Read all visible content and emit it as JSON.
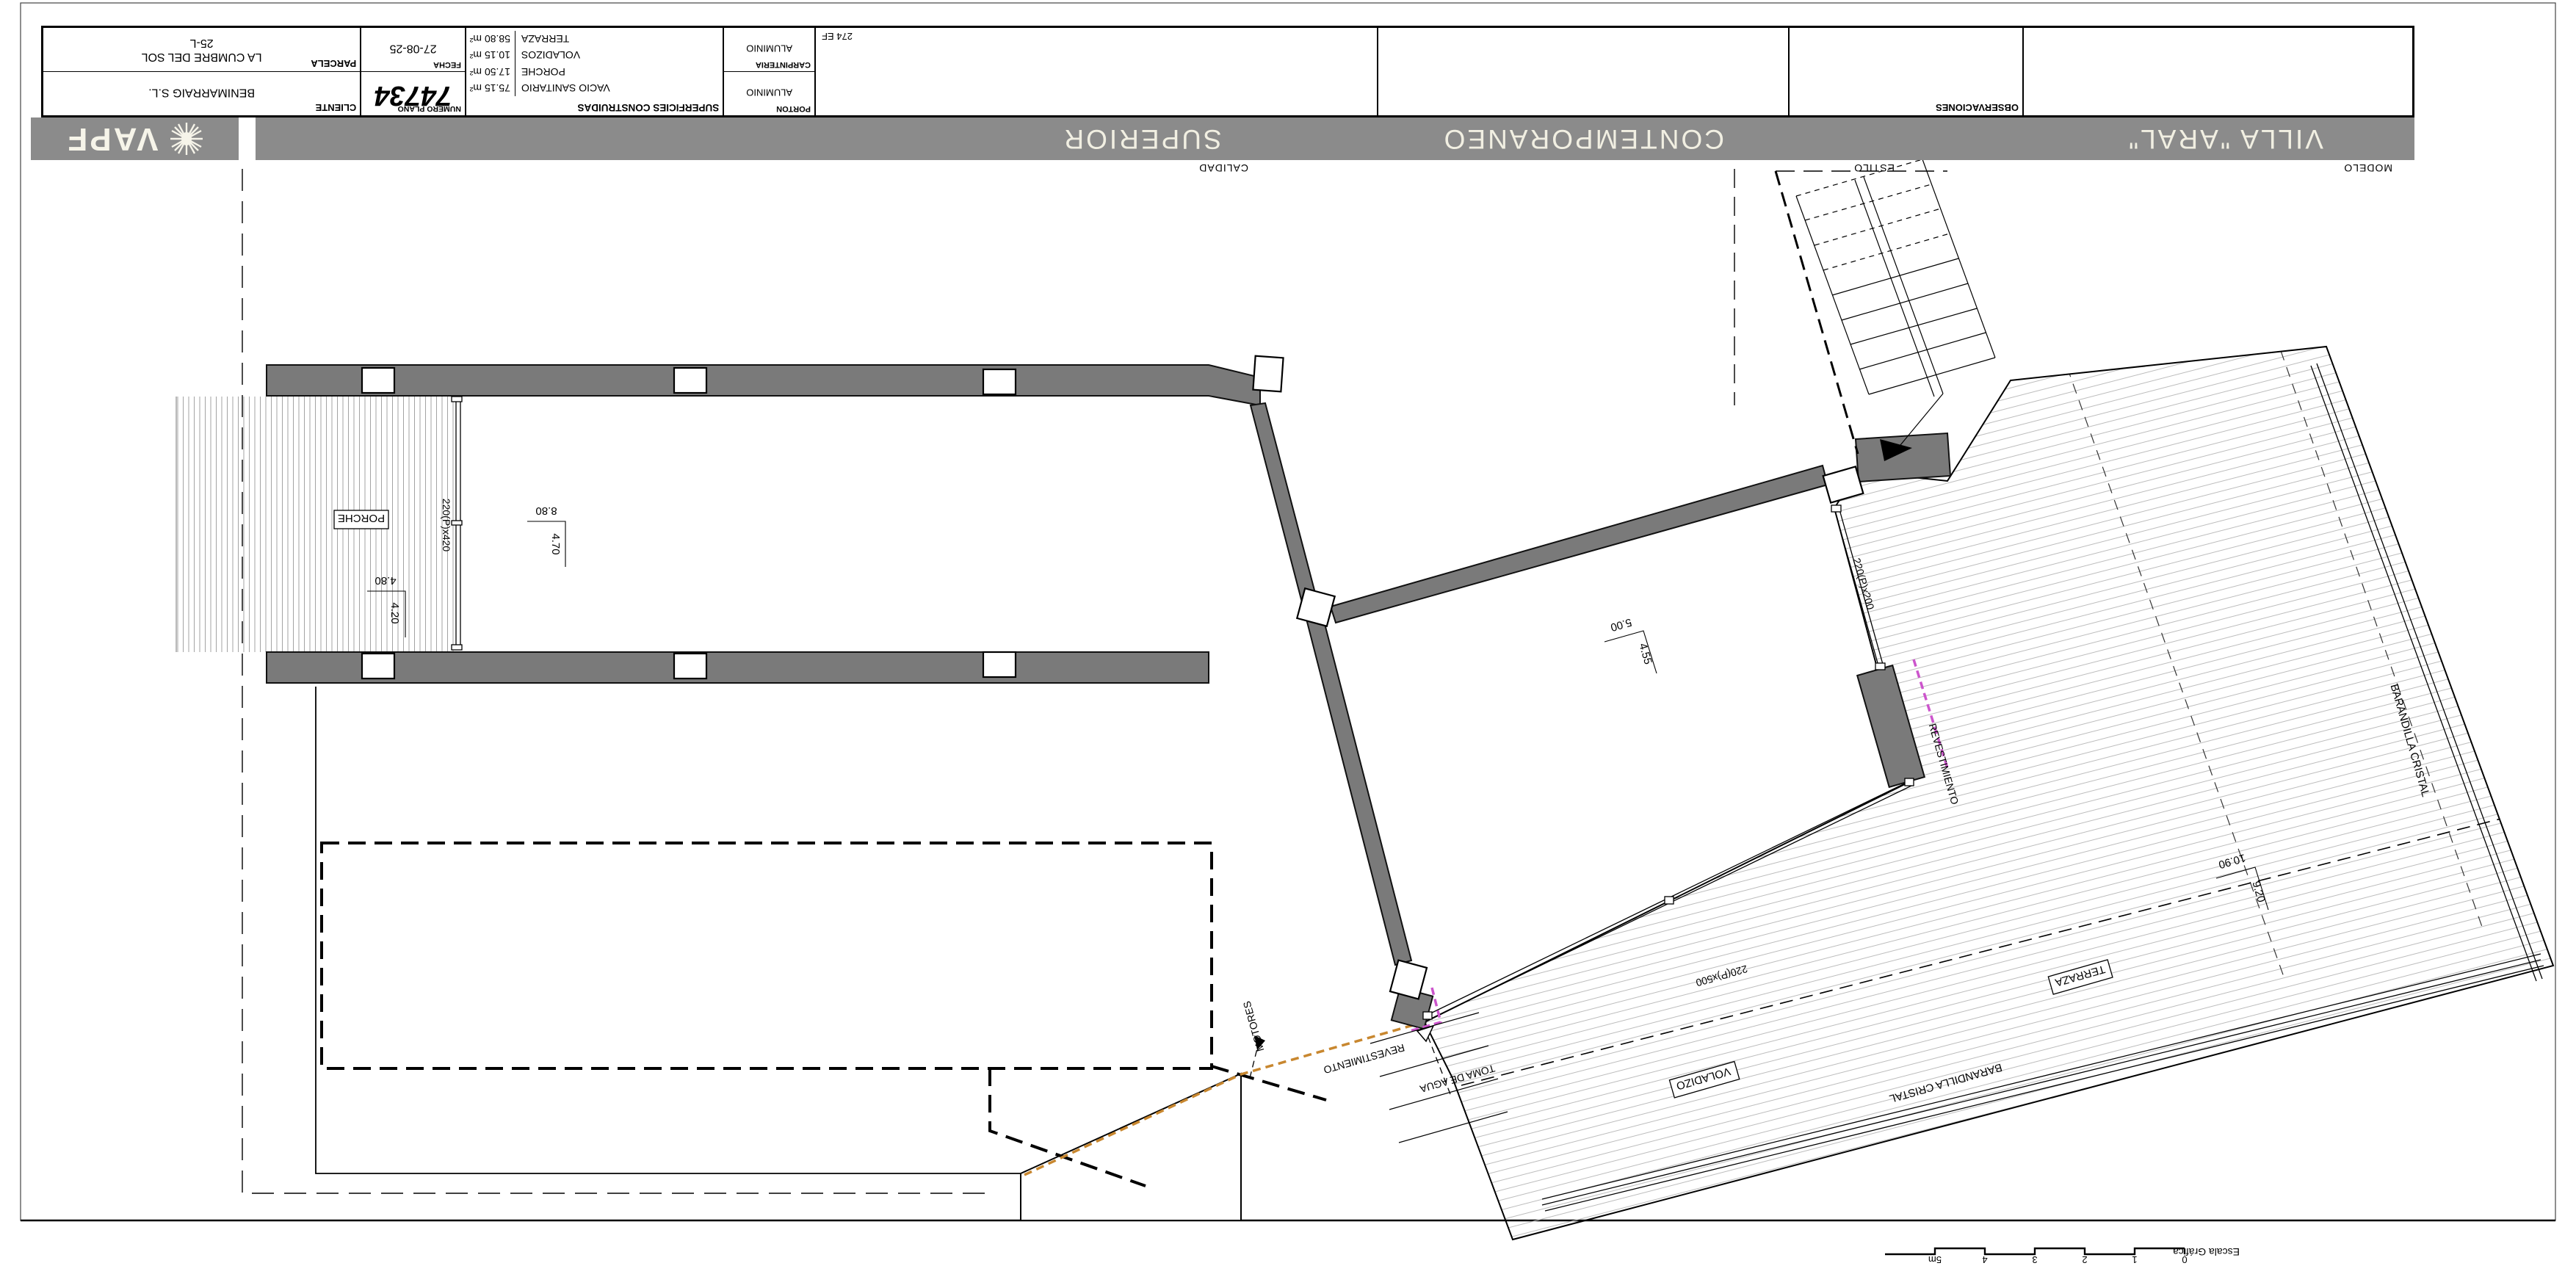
{
  "header": {
    "modelo_label": "MODELO",
    "modelo": "VILLA \"ARAL\"",
    "estilo_label": "ESTILO",
    "estilo": "CONTEMPORANEO",
    "calidad_label": "CALIDAD",
    "calidad": "SUPERIOR",
    "brand": "VAPF"
  },
  "title_block": {
    "observaciones_label": "OBSERVACIONES",
    "ref": "274 EF",
    "carpinteria_label": "CARPINTERIA",
    "carpinteria": "ALUMINIO",
    "porton_label": "PORTON",
    "porton": "ALUMINIO",
    "superficies_label": "SUPERFICIES CONSTRUIDAS",
    "superficies": [
      {
        "name": "VACIO SANITARIO",
        "area": "75.15 m²"
      },
      {
        "name": "PORCHE",
        "area": "17.50 m²"
      },
      {
        "name": "VOLADIZOS",
        "area": "10.15 m²"
      },
      {
        "name": "TERRAZA",
        "area": "58.80 m²"
      }
    ],
    "fecha_label": "FECHA",
    "fecha": "27-08-25",
    "plano_label": "NUMERO PLANO",
    "plano": "74734",
    "parcela_label": "PARCELA",
    "parcela_line1": "LA CUMBRE DEL SOL",
    "parcela_line2": "25-L",
    "cliente_label": "CLIENTE",
    "cliente": "BENIMARRAIG S.L."
  },
  "scalebar": {
    "label": "Escala Gráfica",
    "ticks": [
      "0",
      "1",
      "2",
      "3",
      "4",
      "5m"
    ]
  },
  "plan": {
    "rooms": {
      "porche": "PORCHE",
      "voladizo": "VOLADIZO",
      "terraza": "TERRAZA"
    },
    "annotations": {
      "barandilla": "BARANDILLA CRISTAL",
      "revestimiento": "REVESTIMIENTO",
      "motores": "MOTORES",
      "toma_agua": "TOMA DE AGUA"
    },
    "windows": {
      "porch_door": "220(P)x420",
      "terrace_door": "220(P)x200",
      "voladizo_window": "220(P)x500"
    },
    "dims": {
      "porche_w": "4.80",
      "porche_h": "4.20",
      "salon_w": "8.80",
      "salon_h": "4.70",
      "room_w": "5.00",
      "room_h": "4.55",
      "terraza_w": "10.90",
      "terraza_h": "9.20"
    }
  },
  "colors": {
    "wall": "#7a7a7a",
    "band": "#8b8b8b",
    "magenta": "#cc55cc",
    "orange": "#c8872f"
  }
}
